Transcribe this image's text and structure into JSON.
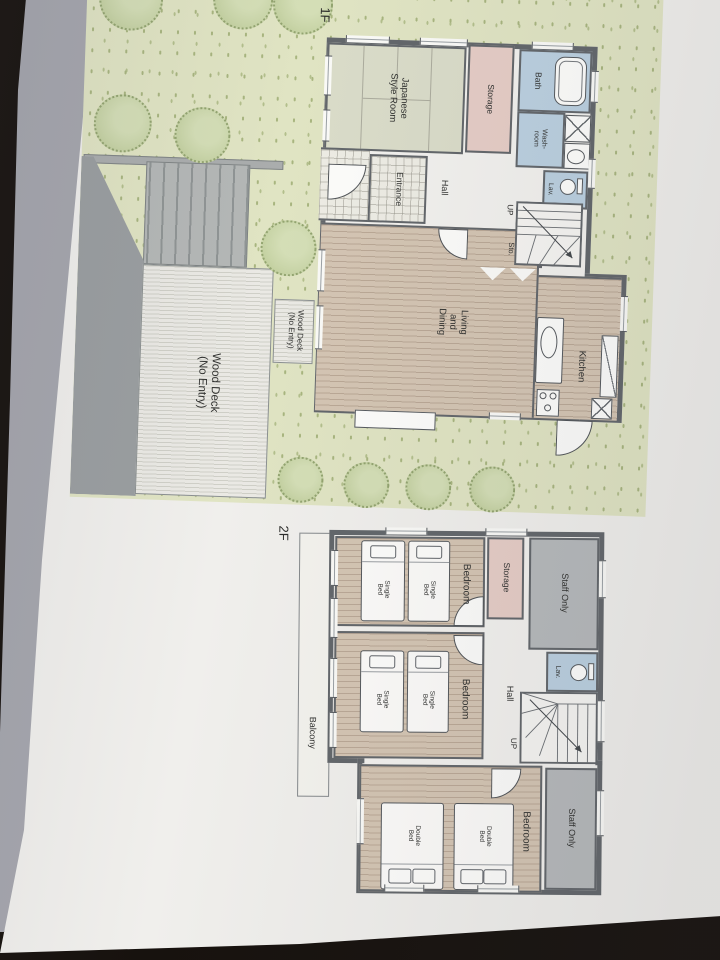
{
  "plan": {
    "floor1": {
      "title": "1F",
      "rooms": {
        "japanese_style_room": "Japanese Style Room",
        "storage": "Storage",
        "bath": "Bath",
        "washroom": "Wash-room",
        "lav": "Lav.",
        "entrance": "Entrance",
        "hall": "Hall",
        "up": "UP",
        "sto": "Sto.",
        "living_dining": "Living and Dining",
        "kitchen": "Kitchen",
        "wood_deck": "Wood Deck (No Entry)"
      }
    },
    "floor2": {
      "title": "2F",
      "rooms": {
        "bedroom": "Bedroom",
        "storage": "Storage",
        "staff_only": "Staff Only",
        "lav": "Lav.",
        "hall": "Hall",
        "up": "UP",
        "balcony": "Balcony"
      },
      "furniture": {
        "single_bed": "Single Bed",
        "double_bed": "Double Bed"
      }
    },
    "colors": {
      "wall": "#63676b",
      "wood_floor": "#d4c5b3",
      "tatami": "#dadcc9",
      "pink_room": "#e6cdc6",
      "blue_room": "#bbd0e0",
      "gray_room": "#b6b9bb",
      "grass": "#e0e4c3",
      "tree": "#ccd7ad",
      "deck": "#eae9e4",
      "paper": "#f0efec",
      "table": "#17120e"
    }
  }
}
